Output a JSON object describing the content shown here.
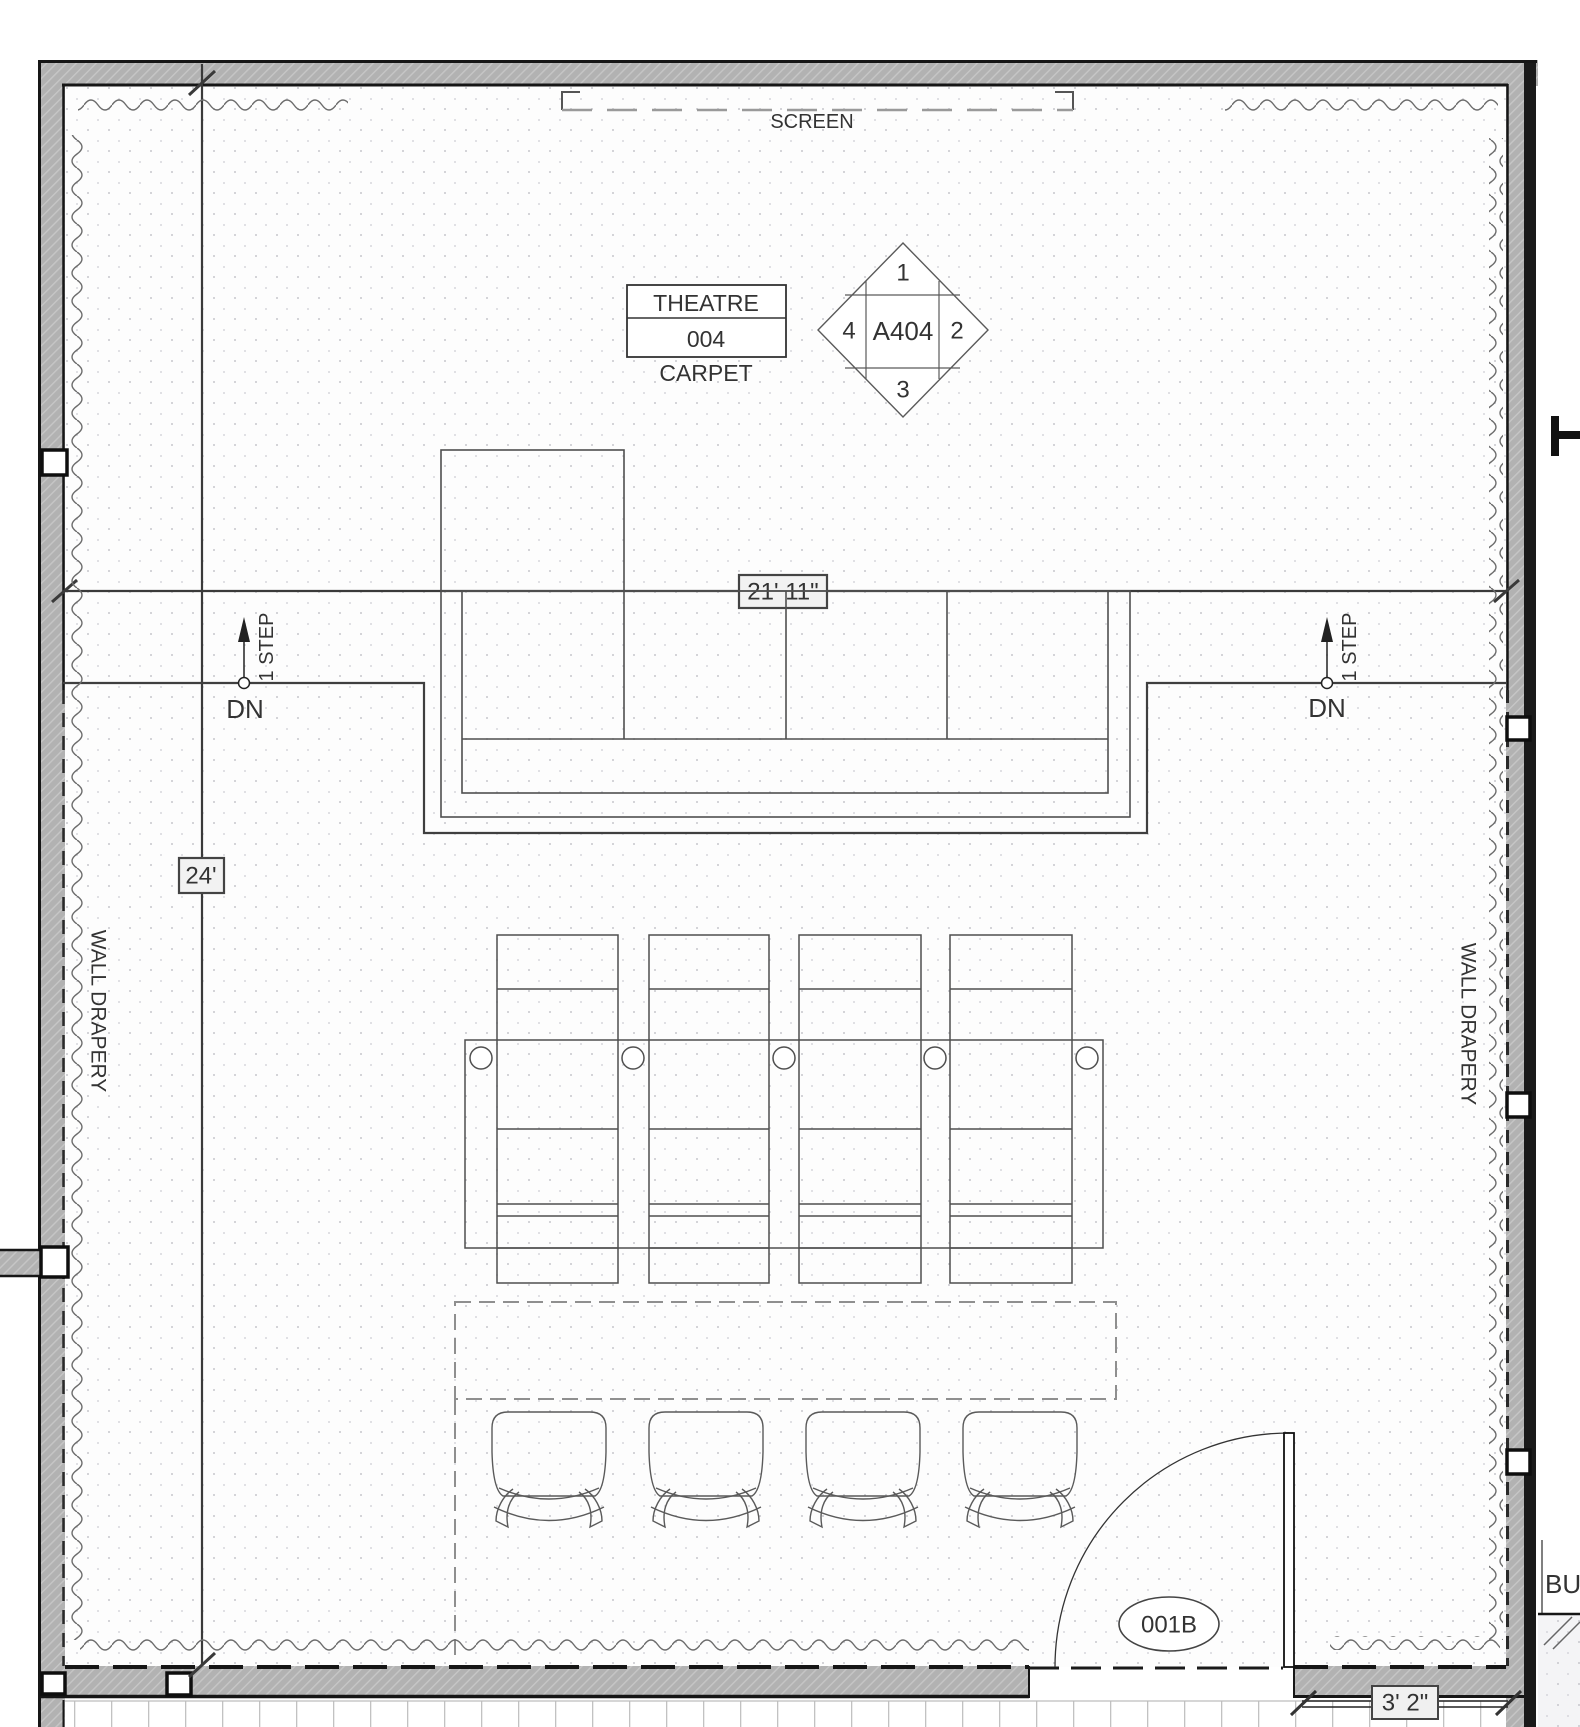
{
  "screen": {
    "label": "SCREEN"
  },
  "room_label": {
    "name": "THEATRE",
    "number": "004",
    "finish": "CARPET"
  },
  "elevation_marker": {
    "center": "A404",
    "top": "1",
    "right": "2",
    "bottom": "3",
    "left": "4"
  },
  "dimensions": {
    "room_width": "21' 11\"",
    "room_depth": "24'",
    "door_wall": "3' 2\""
  },
  "steps": {
    "left": {
      "count_label": "1 STEP",
      "direction": "DN"
    },
    "right": {
      "count_label": "1 STEP",
      "direction": "DN"
    }
  },
  "drapery": {
    "left_label": "WALL DRAPERY",
    "right_label": "WALL DRAPERY",
    "bottom_label": ""
  },
  "door": {
    "tag": "001B"
  },
  "adjacent_room": {
    "label": "BU"
  },
  "colors": {
    "wall_fill": "#b2b2b2",
    "wall_edge": "#161616",
    "annotation": "#3a3a3a",
    "furniture_line": "#555555",
    "dashed_gray": "#8f8f8f",
    "label_box_fill": "#f2f2f2",
    "floor_dot": "#c7c7cd"
  }
}
